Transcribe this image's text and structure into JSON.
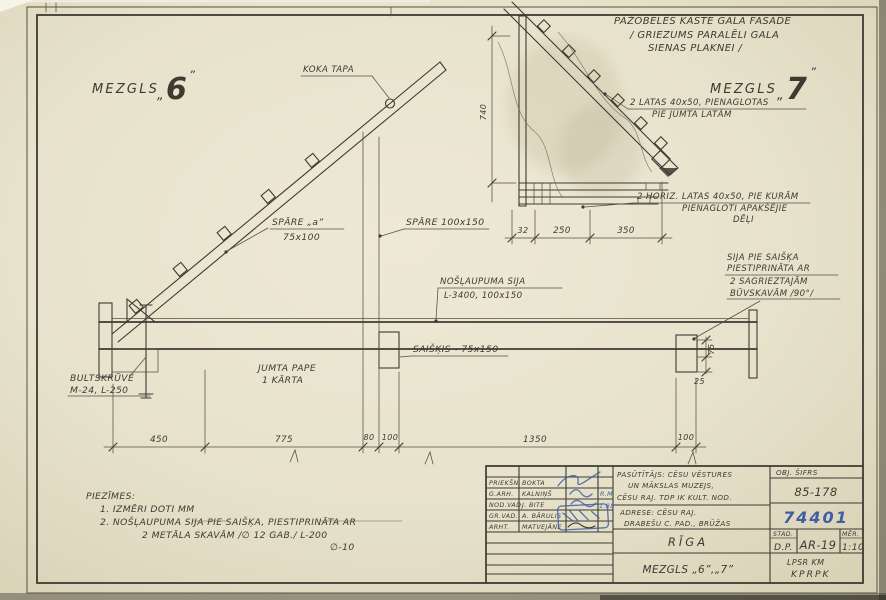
{
  "colors": {
    "paper": "#e7e2cb",
    "ink": "#3e3a31",
    "blue": "#3f5ea6"
  },
  "heading": {
    "line1": "PAŽOBELES KASTE GALA FASĀDĒ",
    "line2": "/ GRIEZUMS PARALĒLI GALA",
    "line3": "SIENAS PLAKNEI /"
  },
  "node6": {
    "title": "MEZGLS",
    "quote_open": "„",
    "number": "6",
    "quote_close": "”",
    "labels": {
      "koka_tapa": "KOKA TAPA",
      "spare_a1": "SPĀRE „a”",
      "spare_a2": "75x100",
      "spare_b": "SPĀRE 100x150",
      "noslaupuma1": "NOŠĻAUPUMA SIJA",
      "noslaupuma2": "L-3400, 100x150",
      "saiskis": "SAIŠĶIS - 75x150",
      "bolt1": "BULTSKRŪVE",
      "bolt2": "M-24, L-250",
      "pape1": "JUMTA PAPE",
      "pape2": "1 KĀRTA"
    },
    "dims": {
      "d450": "450",
      "d775": "775",
      "d80": "80",
      "d100a": "100",
      "d1350": "1350",
      "d100b": "100",
      "d75": "75",
      "d25": "25"
    }
  },
  "node7": {
    "title": "MEZGLS",
    "quote_open": "„",
    "number": "7",
    "quote_close": "”",
    "labels": {
      "latas1": "2 LATAS 40x50, PIENAGLOTAS",
      "latas2": "PIE JUMTA LATĀM",
      "horiz1": "2 HORIZ. LATAS 40x50, PIE KURĀM",
      "horiz2": "PIENAGLOTI APAKŠĒJIE",
      "horiz3": "DĒĻI",
      "sija1": "SIJA PIE SAIŠĶA",
      "sija2": "PIESTIPRINĀTA AR",
      "sija3": "2 SAGRIEZTAJĀM",
      "sija4": "BŪVSKAVĀM /90°/"
    },
    "dims": {
      "d32": "32",
      "d250": "250",
      "d350": "350",
      "height": "740"
    }
  },
  "notes": {
    "title": "PIEZĪMES:",
    "n1": "1. IZMĒRI DOTI MM",
    "n2": "2. NOŠĻAUPUMA SIJA PIE SAIŠĶA, PIESTIPRINĀTA AR",
    "n3": "2 METĀLA SKAVĀM /∅ 12 GAB./ L-200",
    "n4": "∅-10"
  },
  "titleblock": {
    "personnel": [
      {
        "role": "PRIEKŠN.",
        "name": "BOKTA",
        "date": ""
      },
      {
        "role": "G.ARH.",
        "name": "KALNIŅŠ",
        "date": "R.M"
      },
      {
        "role": "NOD.VAD.",
        "name": "J. BITE",
        "date": "1.88"
      },
      {
        "role": "GR.VAD.",
        "name": "A. BĀRULIS",
        "date": ""
      },
      {
        "role": "ARHT.",
        "name": "MATVEJĀNE",
        "date": ""
      }
    ],
    "client1": "PASŪTĪTĀJS: CĒSU VĒSTURES",
    "client2": "UN MĀKSLAS MUZEJS,",
    "client3": "CĒSU RAJ. TDP IK KULT. NOD.",
    "addr1": "ADRESE: CĒSU RAJ.",
    "addr2": "DRABEŠU C. PAD., BRŪŽAS",
    "obj_label": "OBJ. ŠIFRS",
    "obj_code": "85-178",
    "project_no": "74401",
    "stage_label": "STAD.",
    "stage_value": "D.P.",
    "sheet_code": "AR-19",
    "scale_label": "MĒR.",
    "scale_value": "1:10",
    "city": "RĪGA",
    "sheet_title": "MEZGLS „6”,„7”",
    "org1": "LPSR KM",
    "org2": "KPRPK"
  }
}
